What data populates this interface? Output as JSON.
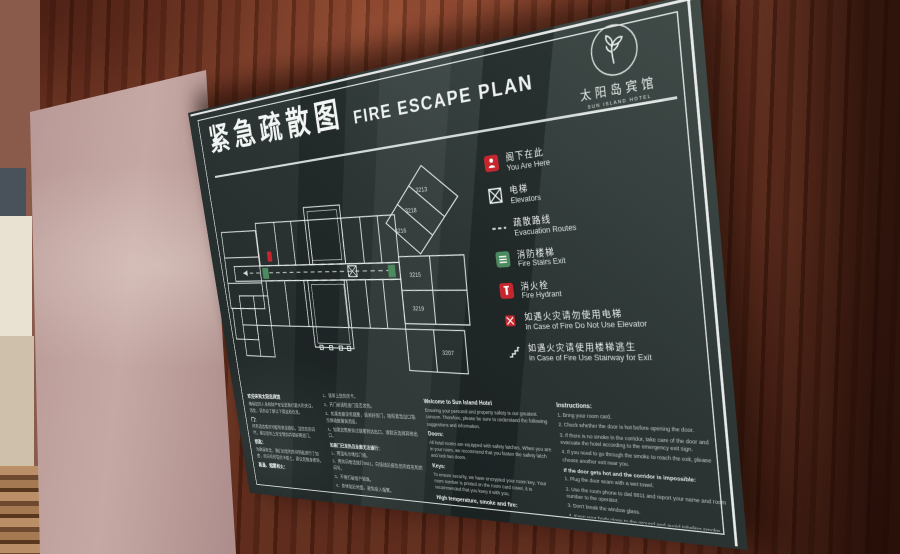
{
  "sign": {
    "title_cn": "紧急疏散图",
    "title_en": "FIRE ESCAPE PLAN",
    "logo": {
      "hotel_name_cn": "太阳岛宾馆",
      "hotel_name_en": "SUN ISLAND HOTEL"
    },
    "legend": {
      "items": [
        {
          "icon": "you-are-here-icon",
          "label_cn": "阁下在此",
          "label_en": "You Are Here"
        },
        {
          "icon": "elevator-icon",
          "label_cn": "电梯",
          "label_en": "Elevators"
        },
        {
          "icon": "route-icon",
          "label_cn": "疏散路线",
          "label_en": "Evacuation Routes"
        },
        {
          "icon": "stairs-icon",
          "label_cn": "消防楼梯",
          "label_en": "Fire Stairs Exit"
        },
        {
          "icon": "hydrant-icon",
          "label_cn": "消火栓",
          "label_en": "Fire Hydrant"
        },
        {
          "icon": "no-elevator-icon",
          "label_cn": "如遇火灾请勿使用电梯",
          "label_en": "In Case of Fire Do Not Use Elevator"
        },
        {
          "icon": "stairway-exit-icon",
          "label_cn": "如遇火灾请使用楼梯逃生",
          "label_en": "In Case of Fire Use Stairway for Exit"
        }
      ]
    },
    "floor_plan": {
      "room_labels": [
        {
          "t": "3213",
          "x": 256,
          "y": 30
        },
        {
          "t": "3218",
          "x": 243,
          "y": 47
        },
        {
          "t": "3216",
          "x": 230,
          "y": 64
        },
        {
          "t": "3215",
          "x": 241,
          "y": 103
        },
        {
          "t": "3219",
          "x": 241,
          "y": 133
        },
        {
          "t": "3207",
          "x": 268,
          "y": 172
        }
      ]
    },
    "footer_columns": [
      {
        "name": "welcome-cn",
        "lang": "cn",
        "blocks": [
          {
            "t": "h",
            "text": "欢迎来到太阳岛宾馆"
          },
          {
            "t": "p",
            "text": "确保您的人身和财产安全是我们最大的关注，因此，请务必了解以下建议和信息。"
          },
          {
            "t": "h",
            "text": "门："
          },
          {
            "t": "p",
            "text": "所有酒店客房均配有安全锁扣，当您在房间时，建议您扣上安全锁扣并锁好两道门。"
          },
          {
            "t": "h",
            "text": "钥匙："
          },
          {
            "t": "p",
            "text": "为确保安全，我们对您的房间钥匙进行了加密，房间号印在房卡套上，建议您随身携带。"
          },
          {
            "t": "h",
            "text": "高温、烟雾和火："
          }
        ]
      },
      {
        "name": "instructions-cn",
        "lang": "cn",
        "blocks": [
          {
            "t": "p",
            "text": "1、请带上您的房卡。"
          },
          {
            "t": "p",
            "text": "2、开门前请检查门是否发热。"
          },
          {
            "t": "p",
            "text": "3、如果走廊没有烟雾，请关好房门，按照紧急出口指示牌疏散撤离酒店。"
          },
          {
            "t": "p",
            "text": "4、如果您需要穿过烟雾到达出口，请就近选择其他出口。"
          },
          {
            "t": "h2",
            "text": "如果门已发热且走廊无法通行："
          },
          {
            "t": "p",
            "text": "1、用湿毛巾堵住门缝。"
          },
          {
            "t": "p",
            "text": "2、用房间电话拨打8811，向接线员报告您的姓名和房间号。"
          },
          {
            "t": "p",
            "text": "3、不要打破窗户玻璃。"
          },
          {
            "t": "p",
            "text": "4、身体贴近地面，避免吸入烟雾。"
          },
          {
            "t": "p",
            "text": "5、请记住，消防队会迅速赶到现场救援，请不要惊慌。"
          }
        ]
      },
      {
        "name": "welcome-en",
        "lang": "en",
        "blocks": [
          {
            "t": "h",
            "text": "Welcome to Sun Island Hotel"
          },
          {
            "t": "p",
            "text": "Ensuring your personal and property safety is our greatest concern. Therefore, please be sure to understand the following suggestions and information."
          },
          {
            "t": "h",
            "text": "Doors:"
          },
          {
            "t": "p",
            "text": "All hotel rooms are equipped with safety latches. When you are in your room, we recommend that you fasten the safety latch and lock two doors."
          },
          {
            "t": "h",
            "text": "Keys:"
          },
          {
            "t": "p",
            "text": "To ensure security, we have encrypted your room key. Your room number is printed on the room card cover, it is recommended that you keep it with you."
          },
          {
            "t": "h",
            "text": "High temperature, smoke and fire:"
          }
        ]
      },
      {
        "name": "instructions-en",
        "lang": "en",
        "blocks": [
          {
            "t": "h",
            "text": "Instructions:"
          },
          {
            "t": "p",
            "text": "1. Bring your room card."
          },
          {
            "t": "p",
            "text": "2. Check whether the door is hot before opening the door."
          },
          {
            "t": "p",
            "text": "3. If there is no smoke in the corridor, take care of the door and evacuate the hotel according to the emergency exit sign."
          },
          {
            "t": "p",
            "text": "4. If you need to go through the smoke to reach the exit, please choose another exit near you."
          },
          {
            "t": "h2",
            "text": "If the door gets hot and the corridor is impossible:"
          },
          {
            "t": "p",
            "text": "1. Plug the door seam with a wet towel."
          },
          {
            "t": "p",
            "text": "2. Use the room phone to dial 8811 and report your name and room number to the operator."
          },
          {
            "t": "p",
            "text": "3. Don't break the window glass."
          },
          {
            "t": "p",
            "text": "4. Keep your body close to the ground and avoid inhaling smoke."
          },
          {
            "t": "p",
            "text": "5. Remember the fire brigade will arrive at the scene quickly for rescue. Please don't panic."
          },
          {
            "t": "p",
            "text": "The above are fire prevention instructions. If you have any questions, please contact the building staff."
          }
        ]
      }
    ],
    "colors": {
      "panel": "#2b3433",
      "text": "#eef3f1",
      "accent_red": "#c6272e",
      "accent_green": "#4c8a5f",
      "wood": "#7a3a27"
    }
  }
}
